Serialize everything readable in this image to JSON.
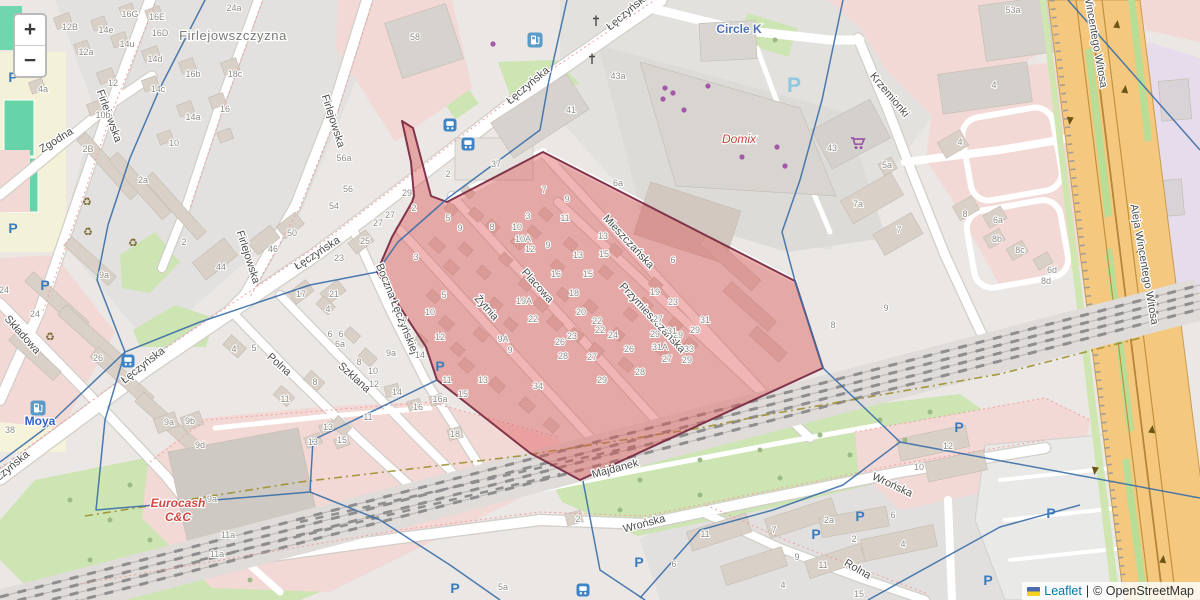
{
  "map": {
    "controls": {
      "zoom_in": "+",
      "zoom_out": "−"
    },
    "attribution": {
      "flag_icon": "ukraine-flag",
      "leaflet_label": "Leaflet",
      "separator": "|",
      "osm_label": "© OpenStreetMap"
    },
    "colors": {
      "highlight_fill": "#db5252",
      "highlight_stroke": "#7b2c43",
      "boundary_blue": "#3a6ea8",
      "road_white": "#ffffff",
      "highway_orange": "#f4c87f",
      "green": "#cde4b3",
      "pink": "#f3d9d6",
      "parking_blue": "#3b7cc0",
      "poi_purple": "#a259a8"
    },
    "place_labels": [
      {
        "t": "Firlejowszczyzna",
        "x": 233,
        "y": 40,
        "r": 0
      }
    ],
    "street_labels": [
      {
        "t": "Łęczyńska",
        "x": 630,
        "y": 14,
        "r": -40
      },
      {
        "t": "Łęczyńska",
        "x": 530,
        "y": 88,
        "r": -40
      },
      {
        "t": "Łęczyńska",
        "x": 319,
        "y": 256,
        "r": -33
      },
      {
        "t": "Łęczyńska",
        "x": 145,
        "y": 368,
        "r": -38
      },
      {
        "t": "Łęczyńska",
        "x": 10,
        "y": 472,
        "r": -40
      },
      {
        "t": "Firlejowska",
        "x": 106,
        "y": 117,
        "r": 70
      },
      {
        "t": "Firlejowska",
        "x": 330,
        "y": 122,
        "r": 72
      },
      {
        "t": "Firlejowska",
        "x": 245,
        "y": 258,
        "r": 72
      },
      {
        "t": "Zgodna",
        "x": 58,
        "y": 143,
        "r": -32
      },
      {
        "t": "Składowa",
        "x": 20,
        "y": 337,
        "r": 48
      },
      {
        "t": "Boczna Łęczyńskiej",
        "x": 394,
        "y": 310,
        "r": 68
      },
      {
        "t": "Polna",
        "x": 277,
        "y": 367,
        "r": 42
      },
      {
        "t": "Szklana",
        "x": 352,
        "y": 380,
        "r": 42
      },
      {
        "t": "Placowa",
        "x": 535,
        "y": 288,
        "r": 48
      },
      {
        "t": "Żytnia",
        "x": 484,
        "y": 310,
        "r": 48
      },
      {
        "t": "Mieszczańska",
        "x": 626,
        "y": 244,
        "r": 47
      },
      {
        "t": "Przymieszczańska",
        "x": 650,
        "y": 320,
        "r": 47
      },
      {
        "t": "Krzemionki",
        "x": 887,
        "y": 97,
        "r": 50
      },
      {
        "t": "Majdanek",
        "x": 616,
        "y": 472,
        "r": -15
      },
      {
        "t": "Wrońska",
        "x": 645,
        "y": 527,
        "r": -15
      },
      {
        "t": "Wrońska",
        "x": 891,
        "y": 488,
        "r": 25
      },
      {
        "t": "Rolna",
        "x": 856,
        "y": 572,
        "r": 30
      },
      {
        "t": "Aleja Wincentego Witosa",
        "x": 1141,
        "y": 265,
        "r": 80
      },
      {
        "t": "Aleja Wincentego Witosa",
        "x": 1090,
        "y": 28,
        "r": 80
      }
    ],
    "poi_labels": [
      {
        "t": "Circle K",
        "x": 739,
        "y": 33,
        "c": "#4a6fb3",
        "fs": 12,
        "fw": "bold"
      },
      {
        "t": "Domix",
        "x": 739,
        "y": 143,
        "c": "#c2453a",
        "fs": 12,
        "fst": "italic"
      },
      {
        "t": "Eurocash",
        "x": 178,
        "y": 507,
        "c": "#d04843",
        "fs": 12,
        "fw": "bold",
        "fst": "italic"
      },
      {
        "t": "C&C",
        "x": 178,
        "y": 521,
        "c": "#d04843",
        "fs": 12,
        "fw": "bold",
        "fst": "italic"
      },
      {
        "t": "Moya",
        "x": 40,
        "y": 425,
        "c": "#2d62c9",
        "fs": 12,
        "fw": "bold"
      }
    ],
    "house_numbers": [
      [
        "16G",
        130,
        17
      ],
      [
        "16E",
        157,
        20
      ],
      [
        "12B",
        70,
        30
      ],
      [
        "14e",
        106,
        33
      ],
      [
        "16D",
        160,
        36
      ],
      [
        "24a",
        234,
        11
      ],
      [
        "14u",
        127,
        47
      ],
      [
        "12a",
        86,
        55
      ],
      [
        "14d",
        155,
        62
      ],
      [
        "12",
        113,
        86
      ],
      [
        "16b",
        193,
        77
      ],
      [
        "18c",
        235,
        77
      ],
      [
        "14c",
        158,
        92
      ],
      [
        "4a",
        43,
        92
      ],
      [
        "10b",
        103,
        118
      ],
      [
        "16",
        225,
        112
      ],
      [
        "14a",
        193,
        120
      ],
      [
        "10",
        174,
        146
      ],
      [
        "2B",
        88,
        152
      ],
      [
        "2a",
        143,
        183
      ],
      [
        "56a",
        344,
        161
      ],
      [
        "56",
        348,
        192
      ],
      [
        "54",
        334,
        209
      ],
      [
        "58",
        415,
        40
      ],
      [
        "27",
        390,
        218
      ],
      [
        "27",
        378,
        226
      ],
      [
        "25",
        365,
        244
      ],
      [
        "23",
        339,
        261
      ],
      [
        "9a",
        104,
        278
      ],
      [
        "24",
        4,
        293
      ],
      [
        "24",
        35,
        317
      ],
      [
        "26",
        98,
        361
      ],
      [
        "38",
        10,
        433
      ],
      [
        "2",
        184,
        245
      ],
      [
        "44",
        221,
        270
      ],
      [
        "46",
        273,
        252
      ],
      [
        "50",
        292,
        236
      ],
      [
        "17",
        301,
        297
      ],
      [
        "21",
        334,
        297
      ],
      [
        "4",
        328,
        312
      ],
      [
        "6",
        330,
        337
      ],
      [
        "6",
        341,
        337
      ],
      [
        "6a",
        340,
        347
      ],
      [
        "8",
        359,
        365
      ],
      [
        "9a",
        391,
        356
      ],
      [
        "10",
        373,
        374
      ],
      [
        "12",
        374,
        387
      ],
      [
        "11",
        368,
        420
      ],
      [
        "4",
        234,
        352
      ],
      [
        "5",
        254,
        351
      ],
      [
        "8",
        315,
        385
      ],
      [
        "11",
        285,
        402
      ],
      [
        "9a",
        169,
        425
      ],
      [
        "9b",
        190,
        424
      ],
      [
        "9d",
        200,
        448
      ],
      [
        "9a",
        212,
        502
      ],
      [
        "11a",
        228,
        538
      ],
      [
        "11a",
        217,
        557
      ],
      [
        "13",
        328,
        430
      ],
      [
        "13",
        313,
        445
      ],
      [
        "15",
        342,
        443
      ],
      [
        "14",
        397,
        395
      ],
      [
        "16a",
        440,
        402
      ],
      [
        "16",
        418,
        410
      ],
      [
        "18",
        455,
        437
      ],
      [
        "37",
        496,
        167
      ],
      [
        "41",
        571,
        113
      ],
      [
        "43a",
        618,
        79
      ],
      [
        "53a",
        1013,
        13
      ],
      [
        "43",
        832,
        151
      ],
      [
        "4",
        994,
        88
      ],
      [
        "4",
        960,
        145
      ],
      [
        "5a",
        887,
        168
      ],
      [
        "7a",
        858,
        207
      ],
      [
        "7",
        899,
        233
      ],
      [
        "8",
        965,
        217
      ],
      [
        "6a",
        998,
        223
      ],
      [
        "8b",
        997,
        242
      ],
      [
        "8c",
        1020,
        253
      ],
      [
        "6d",
        1052,
        273
      ],
      [
        "8d",
        1046,
        284
      ],
      [
        "2",
        448,
        177
      ],
      [
        "29",
        407,
        196
      ],
      [
        "2",
        414,
        211
      ],
      [
        "5",
        448,
        221
      ],
      [
        "9",
        460,
        231
      ],
      [
        "8",
        492,
        230
      ],
      [
        "3",
        416,
        260
      ],
      [
        "3",
        528,
        219
      ],
      [
        "10",
        517,
        230
      ],
      [
        "10A",
        523,
        242
      ],
      [
        "12",
        530,
        252
      ],
      [
        "9",
        548,
        248
      ],
      [
        "7",
        544,
        193
      ],
      [
        "9",
        567,
        202
      ],
      [
        "11",
        565,
        221
      ],
      [
        "13",
        603,
        239
      ],
      [
        "13",
        578,
        258
      ],
      [
        "16",
        556,
        277
      ],
      [
        "15",
        588,
        277
      ],
      [
        "18",
        574,
        296
      ],
      [
        "15",
        604,
        257
      ],
      [
        "19A",
        524,
        304
      ],
      [
        "22",
        533,
        322
      ],
      [
        "20",
        581,
        315
      ],
      [
        "22",
        597,
        324
      ],
      [
        "22",
        600,
        333
      ],
      [
        "24",
        613,
        338
      ],
      [
        "23",
        572,
        339
      ],
      [
        "26",
        560,
        345
      ],
      [
        "28",
        563,
        359
      ],
      [
        "27",
        592,
        360
      ],
      [
        "26",
        629,
        352
      ],
      [
        "27",
        667,
        362
      ],
      [
        "29",
        687,
        363
      ],
      [
        "28",
        640,
        375
      ],
      [
        "29",
        678,
        338
      ],
      [
        "31A",
        660,
        350
      ],
      [
        "33",
        689,
        352
      ],
      [
        "31",
        672,
        334
      ],
      [
        "27",
        658,
        322
      ],
      [
        "29",
        655,
        337
      ],
      [
        "23",
        673,
        305
      ],
      [
        "19",
        655,
        295
      ],
      [
        "29",
        695,
        333
      ],
      [
        "31",
        705,
        323
      ],
      [
        "6",
        673,
        263
      ],
      [
        "6a",
        618,
        186
      ],
      [
        "5",
        444,
        298
      ],
      [
        "10",
        430,
        315
      ],
      [
        "12",
        440,
        340
      ],
      [
        "7",
        405,
        324
      ],
      [
        "14",
        420,
        358
      ],
      [
        "9A",
        503,
        342
      ],
      [
        "9",
        510,
        353
      ],
      [
        "11",
        447,
        383
      ],
      [
        "13",
        483,
        383
      ],
      [
        "15",
        463,
        397
      ],
      [
        "34",
        538,
        389
      ],
      [
        "29",
        602,
        383
      ],
      [
        "2",
        578,
        522
      ],
      [
        "5a",
        503,
        590
      ],
      [
        "6",
        674,
        567
      ],
      [
        "11",
        705,
        537
      ],
      [
        "7",
        774,
        533
      ],
      [
        "2a",
        829,
        523
      ],
      [
        "2",
        854,
        542
      ],
      [
        "4",
        903,
        547
      ],
      [
        "9",
        797,
        560
      ],
      [
        "11",
        823,
        568
      ],
      [
        "4",
        783,
        588
      ],
      [
        "15",
        859,
        597
      ],
      [
        "6",
        893,
        518
      ],
      [
        "10",
        919,
        470
      ],
      [
        "12",
        948,
        449
      ],
      [
        "8",
        833,
        328
      ],
      [
        "9",
        886,
        311
      ]
    ],
    "icons": [
      {
        "type": "parking",
        "x": 13,
        "y": 77
      },
      {
        "type": "parking",
        "x": 13,
        "y": 228
      },
      {
        "type": "parking",
        "x": 45,
        "y": 285
      },
      {
        "type": "parking",
        "x": 440,
        "y": 366
      },
      {
        "type": "parking",
        "x": 639,
        "y": 562
      },
      {
        "type": "parking",
        "x": 816,
        "y": 534
      },
      {
        "type": "parking",
        "x": 860,
        "y": 516
      },
      {
        "type": "parking",
        "x": 959,
        "y": 427
      },
      {
        "type": "parking",
        "x": 988,
        "y": 580
      },
      {
        "type": "parking",
        "x": 1051,
        "y": 513
      },
      {
        "type": "parking",
        "x": 455,
        "y": 588
      },
      {
        "type": "parking",
        "x": 794,
        "y": 86,
        "big": true
      },
      {
        "type": "bus",
        "x": 450,
        "y": 127
      },
      {
        "type": "bus",
        "x": 468,
        "y": 146
      },
      {
        "type": "bus",
        "x": 128,
        "y": 363
      },
      {
        "type": "bus",
        "x": 583,
        "y": 592
      },
      {
        "type": "fuel",
        "x": 535,
        "y": 42
      },
      {
        "type": "fuel",
        "x": 38,
        "y": 410
      },
      {
        "type": "cart",
        "x": 858,
        "y": 145
      },
      {
        "type": "recycling",
        "x": 87,
        "y": 202
      },
      {
        "type": "recycling",
        "x": 88,
        "y": 232
      },
      {
        "type": "recycling",
        "x": 133,
        "y": 243
      },
      {
        "type": "recycling",
        "x": 50,
        "y": 337
      },
      {
        "type": "shop-dot",
        "x": 665,
        "y": 87
      },
      {
        "type": "shop-dot",
        "x": 673,
        "y": 92
      },
      {
        "type": "shop-dot",
        "x": 663,
        "y": 98
      },
      {
        "type": "shop-dot",
        "x": 684,
        "y": 109
      },
      {
        "type": "shop-dot",
        "x": 708,
        "y": 85
      },
      {
        "type": "shop-dot",
        "x": 777,
        "y": 146
      },
      {
        "type": "shop-dot",
        "x": 742,
        "y": 156
      },
      {
        "type": "shop-dot",
        "x": 785,
        "y": 165
      },
      {
        "type": "shop-dot",
        "x": 493,
        "y": 43
      },
      {
        "type": "worship",
        "x": 596,
        "y": 23
      },
      {
        "type": "worship",
        "x": 592,
        "y": 61
      }
    ]
  }
}
